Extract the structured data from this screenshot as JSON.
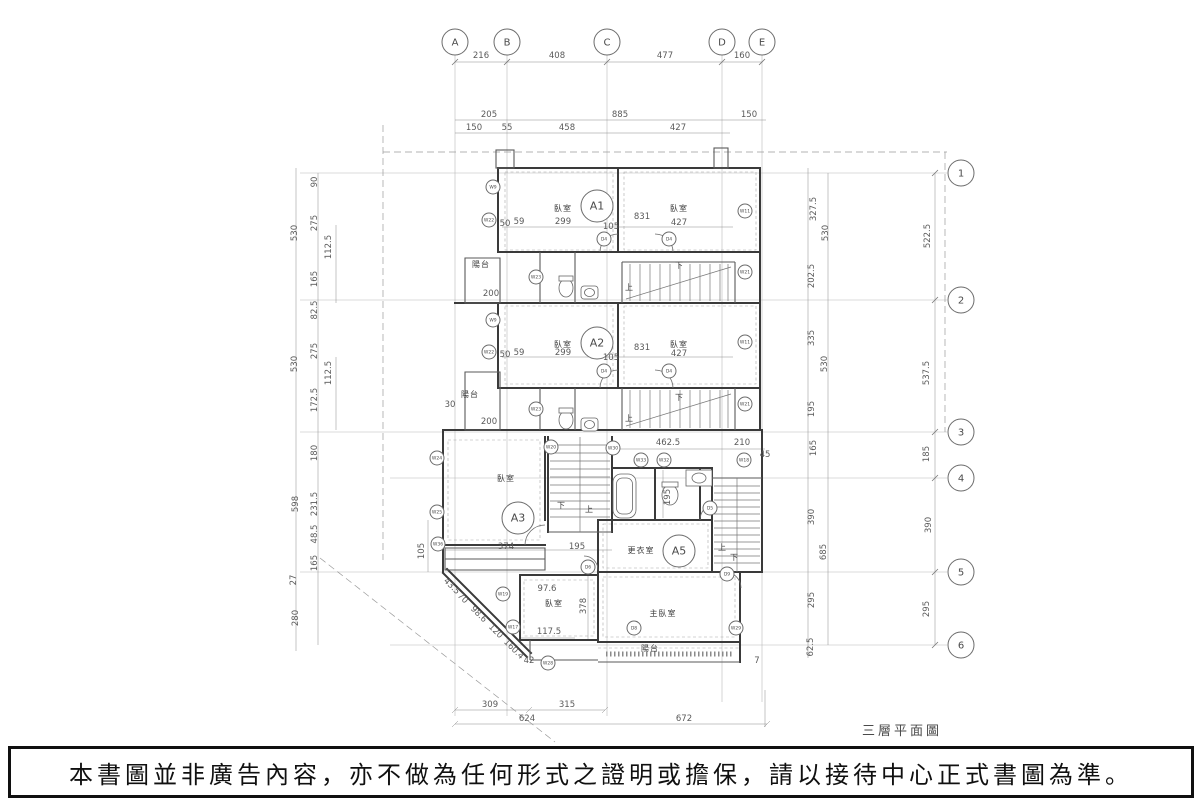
{
  "title": "三層平面圖",
  "disclaimer": "本書圖並非廣告內容，亦不做為任何形式之證明或擔保，請以接待中心正式書圖為準。",
  "colors": {
    "ink": "#3a3a3a",
    "grid_line": "#b3b3b3",
    "dim_text": "#5a5a5a"
  },
  "grid": {
    "columns": [
      {
        "label": "A",
        "x": 455
      },
      {
        "label": "B",
        "x": 507
      },
      {
        "label": "C",
        "x": 607
      },
      {
        "label": "D",
        "x": 722
      },
      {
        "label": "E",
        "x": 762
      }
    ],
    "rows": [
      {
        "label": "1",
        "y": 173
      },
      {
        "label": "2",
        "y": 300
      },
      {
        "label": "3",
        "y": 432
      },
      {
        "label": "4",
        "y": 478
      },
      {
        "label": "5",
        "y": 572
      },
      {
        "label": "6",
        "y": 645
      }
    ]
  },
  "units": [
    {
      "label": "A1",
      "x": 597,
      "y": 206
    },
    {
      "label": "A2",
      "x": 597,
      "y": 343
    },
    {
      "label": "A3",
      "x": 518,
      "y": 518
    },
    {
      "label": "A5",
      "x": 679,
      "y": 551
    }
  ],
  "rooms": [
    {
      "label": "臥室",
      "x": 563,
      "y": 211
    },
    {
      "label": "臥室",
      "x": 679,
      "y": 211
    },
    {
      "label": "臥室",
      "x": 563,
      "y": 347
    },
    {
      "label": "臥室",
      "x": 679,
      "y": 347
    },
    {
      "label": "臥室",
      "x": 506,
      "y": 481
    },
    {
      "label": "臥室",
      "x": 554,
      "y": 606
    },
    {
      "label": "主臥室",
      "x": 663,
      "y": 616
    },
    {
      "label": "更衣室",
      "x": 641,
      "y": 553
    },
    {
      "label": "陽台",
      "x": 481,
      "y": 267
    },
    {
      "label": "陽台",
      "x": 470,
      "y": 397
    },
    {
      "label": "陽台",
      "x": 650,
      "y": 651
    }
  ],
  "stair_labels": [
    {
      "t": "下",
      "x": 679,
      "y": 268
    },
    {
      "t": "上",
      "x": 629,
      "y": 290
    },
    {
      "t": "下",
      "x": 679,
      "y": 400
    },
    {
      "t": "上",
      "x": 629,
      "y": 421
    },
    {
      "t": "下",
      "x": 561,
      "y": 508
    },
    {
      "t": "上",
      "x": 589,
      "y": 512
    },
    {
      "t": "上",
      "x": 722,
      "y": 550
    },
    {
      "t": "下",
      "x": 734,
      "y": 560
    }
  ],
  "dims": [
    {
      "t": "216",
      "x": 481,
      "y": 58
    },
    {
      "t": "408",
      "x": 557,
      "y": 58
    },
    {
      "t": "477",
      "x": 665,
      "y": 58
    },
    {
      "t": "160",
      "x": 742,
      "y": 58
    },
    {
      "t": "205",
      "x": 489,
      "y": 117
    },
    {
      "t": "885",
      "x": 620,
      "y": 117
    },
    {
      "t": "150",
      "x": 749,
      "y": 117
    },
    {
      "t": "150",
      "x": 474,
      "y": 130
    },
    {
      "t": "55",
      "x": 507,
      "y": 130
    },
    {
      "t": "458",
      "x": 567,
      "y": 130
    },
    {
      "t": "427",
      "x": 678,
      "y": 130
    },
    {
      "t": "50",
      "x": 505,
      "y": 226
    },
    {
      "t": "59",
      "x": 519,
      "y": 224
    },
    {
      "t": "299",
      "x": 563,
      "y": 224
    },
    {
      "t": "105",
      "x": 611,
      "y": 229
    },
    {
      "t": "831",
      "x": 642,
      "y": 219
    },
    {
      "t": "427",
      "x": 679,
      "y": 225
    },
    {
      "t": "200",
      "x": 491,
      "y": 296
    },
    {
      "t": "50",
      "x": 505,
      "y": 357
    },
    {
      "t": "59",
      "x": 519,
      "y": 355
    },
    {
      "t": "299",
      "x": 563,
      "y": 355
    },
    {
      "t": "105",
      "x": 611,
      "y": 360
    },
    {
      "t": "831",
      "x": 642,
      "y": 350
    },
    {
      "t": "427",
      "x": 679,
      "y": 356
    },
    {
      "t": "200",
      "x": 489,
      "y": 424
    },
    {
      "t": "30",
      "x": 450,
      "y": 407
    },
    {
      "t": "530",
      "x": 297,
      "y": 233,
      "r": -90
    },
    {
      "t": "530",
      "x": 297,
      "y": 364,
      "r": -90
    },
    {
      "t": "598",
      "x": 298,
      "y": 504,
      "r": -90
    },
    {
      "t": "27",
      "x": 296,
      "y": 580,
      "r": -90
    },
    {
      "t": "280",
      "x": 298,
      "y": 618,
      "r": -90
    },
    {
      "t": "90",
      "x": 317,
      "y": 182,
      "r": -90
    },
    {
      "t": "275",
      "x": 317,
      "y": 223,
      "r": -90
    },
    {
      "t": "112.5",
      "x": 331,
      "y": 247,
      "r": -90
    },
    {
      "t": "165",
      "x": 317,
      "y": 279,
      "r": -90
    },
    {
      "t": "82.5",
      "x": 317,
      "y": 310,
      "r": -90
    },
    {
      "t": "275",
      "x": 317,
      "y": 351,
      "r": -90
    },
    {
      "t": "112.5",
      "x": 331,
      "y": 373,
      "r": -90
    },
    {
      "t": "172.5",
      "x": 317,
      "y": 400,
      "r": -90
    },
    {
      "t": "180",
      "x": 317,
      "y": 453,
      "r": -90
    },
    {
      "t": "231.5",
      "x": 317,
      "y": 504,
      "r": -90
    },
    {
      "t": "48.5",
      "x": 317,
      "y": 534,
      "r": -90
    },
    {
      "t": "165",
      "x": 317,
      "y": 563,
      "r": -90
    },
    {
      "t": "105",
      "x": 424,
      "y": 551,
      "r": -90
    },
    {
      "t": "327.5",
      "x": 816,
      "y": 209,
      "r": -90
    },
    {
      "t": "530",
      "x": 828,
      "y": 233,
      "r": -90
    },
    {
      "t": "202.5",
      "x": 814,
      "y": 276,
      "r": -90
    },
    {
      "t": "335",
      "x": 814,
      "y": 338,
      "r": -90
    },
    {
      "t": "530",
      "x": 827,
      "y": 364,
      "r": -90
    },
    {
      "t": "195",
      "x": 814,
      "y": 409,
      "r": -90
    },
    {
      "t": "165",
      "x": 816,
      "y": 448,
      "r": -90
    },
    {
      "t": "390",
      "x": 814,
      "y": 517,
      "r": -90
    },
    {
      "t": "685",
      "x": 826,
      "y": 552,
      "r": -90
    },
    {
      "t": "295",
      "x": 814,
      "y": 600,
      "r": -90
    },
    {
      "t": "62.5",
      "x": 813,
      "y": 647,
      "r": -90
    },
    {
      "t": "522.5",
      "x": 930,
      "y": 236,
      "r": -90
    },
    {
      "t": "537.5",
      "x": 929,
      "y": 373,
      "r": -90
    },
    {
      "t": "185",
      "x": 929,
      "y": 454,
      "r": -90
    },
    {
      "t": "390",
      "x": 931,
      "y": 525,
      "r": -90
    },
    {
      "t": "295",
      "x": 929,
      "y": 609,
      "r": -90
    },
    {
      "t": "462.5",
      "x": 668,
      "y": 445
    },
    {
      "t": "210",
      "x": 742,
      "y": 445
    },
    {
      "t": "45",
      "x": 765,
      "y": 457
    },
    {
      "t": "195",
      "x": 670,
      "y": 497,
      "r": -90
    },
    {
      "t": "374",
      "x": 506,
      "y": 549
    },
    {
      "t": "195",
      "x": 577,
      "y": 549
    },
    {
      "t": "97.6",
      "x": 547,
      "y": 591
    },
    {
      "t": "378",
      "x": 586,
      "y": 606,
      "r": -90
    },
    {
      "t": "117.5",
      "x": 549,
      "y": 634
    },
    {
      "t": "42",
      "x": 529,
      "y": 663
    },
    {
      "t": "7",
      "x": 757,
      "y": 663
    },
    {
      "t": "43.5",
      "x": 450,
      "y": 588,
      "r": 45
    },
    {
      "t": "70",
      "x": 461,
      "y": 600,
      "r": 45
    },
    {
      "t": "98.6",
      "x": 477,
      "y": 616,
      "r": 45
    },
    {
      "t": "120",
      "x": 494,
      "y": 633,
      "r": 45
    },
    {
      "t": "160.4",
      "x": 512,
      "y": 651,
      "r": 45
    },
    {
      "t": "309",
      "x": 490,
      "y": 707
    },
    {
      "t": "315",
      "x": 567,
      "y": 707
    },
    {
      "t": "624",
      "x": 527,
      "y": 721
    },
    {
      "t": "672",
      "x": 684,
      "y": 721
    }
  ],
  "tags": [
    {
      "l": "W9",
      "x": 493,
      "y": 187
    },
    {
      "l": "W22",
      "x": 489,
      "y": 220
    },
    {
      "l": "W23",
      "x": 536,
      "y": 277
    },
    {
      "l": "D4",
      "x": 604,
      "y": 239
    },
    {
      "l": "D4",
      "x": 669,
      "y": 239
    },
    {
      "l": "W11",
      "x": 745,
      "y": 211
    },
    {
      "l": "W21",
      "x": 745,
      "y": 272
    },
    {
      "l": "W9",
      "x": 493,
      "y": 320
    },
    {
      "l": "W22",
      "x": 489,
      "y": 352
    },
    {
      "l": "W23",
      "x": 536,
      "y": 409
    },
    {
      "l": "D4",
      "x": 604,
      "y": 371
    },
    {
      "l": "D4",
      "x": 669,
      "y": 371
    },
    {
      "l": "W11",
      "x": 745,
      "y": 342
    },
    {
      "l": "W21",
      "x": 745,
      "y": 404
    },
    {
      "l": "W20",
      "x": 551,
      "y": 447
    },
    {
      "l": "W30",
      "x": 613,
      "y": 448
    },
    {
      "l": "W33",
      "x": 641,
      "y": 460
    },
    {
      "l": "W32",
      "x": 664,
      "y": 460
    },
    {
      "l": "W18",
      "x": 744,
      "y": 460
    },
    {
      "l": "W24",
      "x": 437,
      "y": 458
    },
    {
      "l": "W25",
      "x": 437,
      "y": 512
    },
    {
      "l": "W36",
      "x": 438,
      "y": 544
    },
    {
      "l": "D5",
      "x": 710,
      "y": 508
    },
    {
      "l": "D6",
      "x": 588,
      "y": 567
    },
    {
      "l": "D9",
      "x": 727,
      "y": 574
    },
    {
      "l": "W19",
      "x": 503,
      "y": 594
    },
    {
      "l": "W17",
      "x": 513,
      "y": 627
    },
    {
      "l": "W28",
      "x": 548,
      "y": 663
    },
    {
      "l": "D8",
      "x": 634,
      "y": 628
    },
    {
      "l": "W29",
      "x": 736,
      "y": 628
    }
  ]
}
